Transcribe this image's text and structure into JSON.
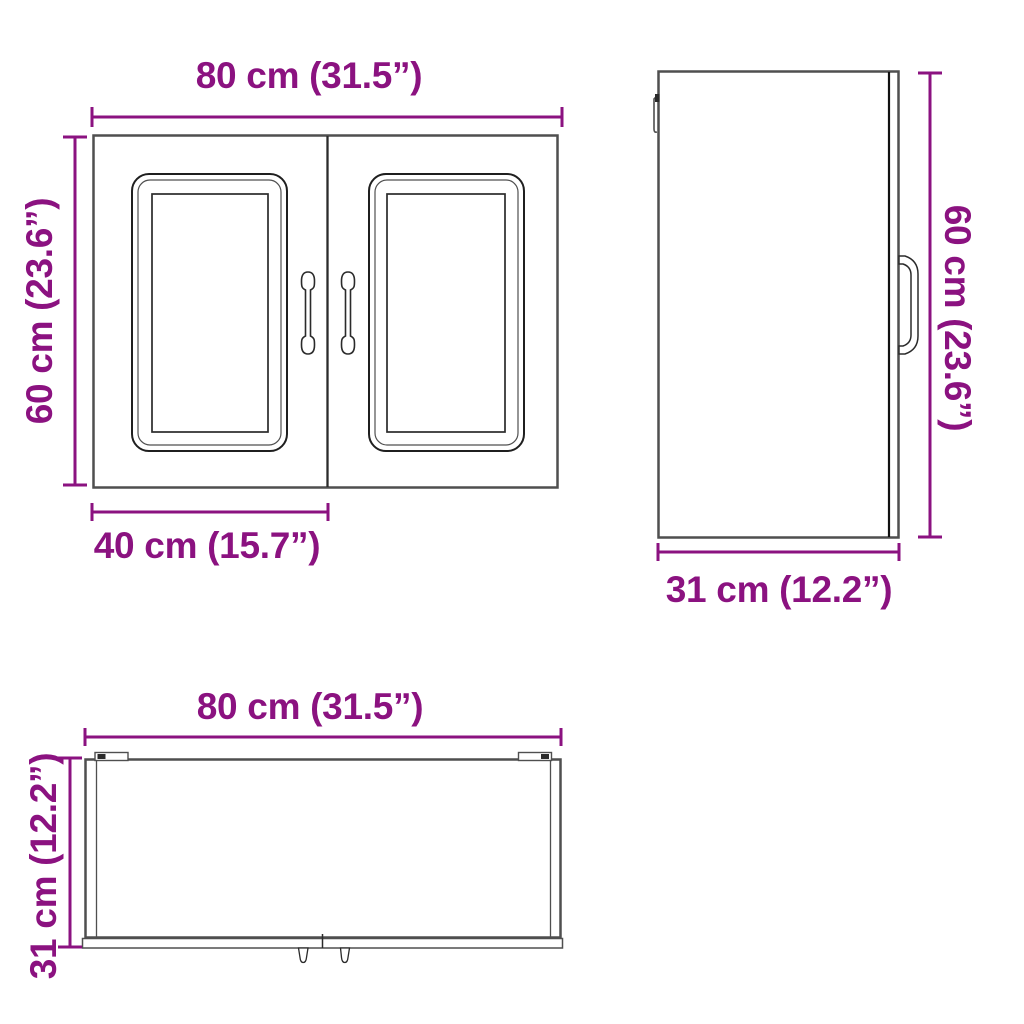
{
  "colors": {
    "dimension_accent": "#8B1280",
    "outline_gray": "#4F4F4F",
    "outline_dark": "#2B2B2B",
    "background": "#FFFFFF"
  },
  "front_view": {
    "width_label": "80 cm (31.5”)",
    "height_label": "60 cm (23.6”)",
    "door_width_label": "40 cm (15.7”)"
  },
  "side_view": {
    "height_label": "60 cm (23.6”)",
    "depth_label": "31 cm (12.2”)"
  },
  "top_view": {
    "width_label": "80 cm (31.5”)",
    "depth_label": "31 cm (12.2”)"
  }
}
